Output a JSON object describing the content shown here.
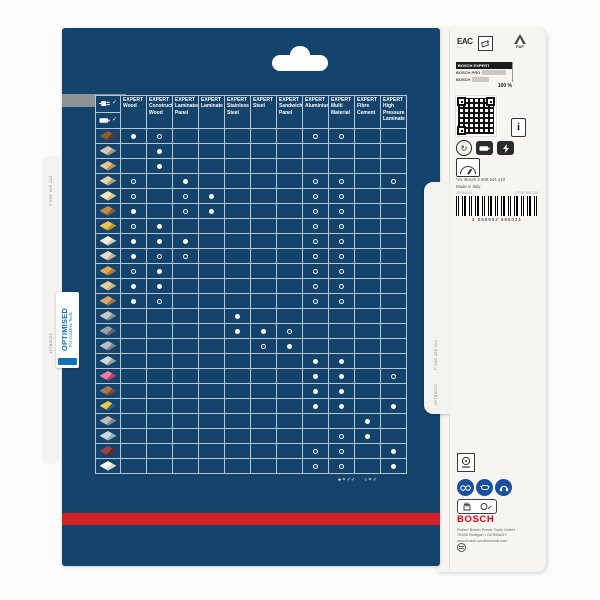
{
  "colors": {
    "panel_blue": "#14436b",
    "stripe_red": "#d42127",
    "bosch_red": "#e20015",
    "grid_line": "#b7c6d3",
    "ppe_blue": "#1a4f9e",
    "optimised_blue": "#1272b9"
  },
  "left_side": {
    "optimised_title": "OPTIMISED",
    "optimised_subtitle": "For Cordless Tools",
    "edge_code_top": "F 03E 426 110",
    "edge_code_bottom": "15TB0025"
  },
  "door_tab": {
    "code_top": "F 03E 426 110",
    "code_bottom": "15TB0025"
  },
  "matrix": {
    "power_rows": [
      {
        "icon": "corded-plug-icon",
        "check": "✓"
      },
      {
        "icon": "cordless-battery-icon",
        "check": "✓"
      }
    ],
    "columns": [
      {
        "brand": "EXPERT",
        "name": "Wood"
      },
      {
        "brand": "EXPERT",
        "name": "Construct Wood"
      },
      {
        "brand": "EXPERT",
        "name": "Laminated Panel"
      },
      {
        "brand": "EXPERT",
        "name": "Laminate"
      },
      {
        "brand": "EXPERT",
        "name": "Stainless Steel"
      },
      {
        "brand": "EXPERT",
        "name": "Steel"
      },
      {
        "brand": "EXPERT",
        "name": "Sandwich Panel"
      },
      {
        "brand": "EXPERT",
        "name": "Aluminium"
      },
      {
        "brand": "EXPERT",
        "name": "Multi Material"
      },
      {
        "brand": "EXPERT",
        "name": "Fibre Cement"
      },
      {
        "brand": "EXPERT",
        "name": "High Pressure Laminate"
      }
    ],
    "rows": [
      {
        "material": "solid-wood",
        "colors": [
          "#5f3a22",
          "#8a5a33"
        ],
        "marks": [
          "f",
          "o",
          "",
          "",
          "",
          "",
          "",
          "o",
          "o",
          "",
          ""
        ]
      },
      {
        "material": "nailed-wood",
        "colors": [
          "#a89a82",
          "#d6c9b0"
        ],
        "marks": [
          "",
          "f",
          "",
          "",
          "",
          "",
          "",
          "",
          "",
          "",
          ""
        ]
      },
      {
        "material": "construction-timber",
        "colors": [
          "#b7945e",
          "#e0c496"
        ],
        "marks": [
          "",
          "f",
          "",
          "",
          "",
          "",
          "",
          "",
          "",
          "",
          ""
        ]
      },
      {
        "material": "chipboard",
        "colors": [
          "#b5a079",
          "#e3d2b0"
        ],
        "marks": [
          "o",
          "",
          "f",
          "",
          "",
          "",
          "",
          "o",
          "o",
          "",
          "o"
        ]
      },
      {
        "material": "laminate-flooring",
        "colors": [
          "#d8c68e",
          "#f2e6c0"
        ],
        "marks": [
          "o",
          "",
          "o",
          "f",
          "",
          "",
          "",
          "o",
          "o",
          "",
          ""
        ]
      },
      {
        "material": "parquet",
        "colors": [
          "#8f5e2d",
          "#c08a4a"
        ],
        "marks": [
          "f",
          "",
          "o",
          "f",
          "",
          "",
          "",
          "o",
          "o",
          "",
          ""
        ]
      },
      {
        "material": "osb-board",
        "colors": [
          "#c79a24",
          "#eec54e"
        ],
        "marks": [
          "o",
          "f",
          "",
          "",
          "",
          "",
          "",
          "o",
          "o",
          "",
          ""
        ]
      },
      {
        "material": "plywood",
        "colors": [
          "#d8ccb2",
          "#f5eee0"
        ],
        "marks": [
          "f",
          "f",
          "f",
          "",
          "",
          "",
          "",
          "o",
          "o",
          "",
          ""
        ]
      },
      {
        "material": "mdf-board",
        "colors": [
          "#c4b190",
          "#e8dcc0"
        ],
        "marks": [
          "f",
          "o",
          "o",
          "",
          "",
          "",
          "",
          "o",
          "o",
          "",
          ""
        ]
      },
      {
        "material": "hardwood",
        "colors": [
          "#b27a34",
          "#e0a855"
        ],
        "marks": [
          "o",
          "f",
          "",
          "",
          "",
          "",
          "",
          "o",
          "o",
          "",
          ""
        ]
      },
      {
        "material": "timber-beams",
        "colors": [
          "#bda briefly",
          "#e2cda0"
        ],
        "marks": [
          "f",
          "f",
          "",
          "",
          "",
          "",
          "",
          "o",
          "o",
          "",
          ""
        ]
      },
      {
        "material": "layered-wood",
        "colors": [
          "#a37846",
          "#d4a870"
        ],
        "marks": [
          "f",
          "o",
          "",
          "",
          "",
          "",
          "",
          "o",
          "o",
          "",
          ""
        ]
      },
      {
        "material": "stainless-steel-sheet",
        "colors": [
          "#8a9298",
          "#c2c8cc"
        ],
        "marks": [
          "",
          "",
          "",
          "",
          "f",
          "",
          "",
          "",
          "",
          "",
          ""
        ]
      },
      {
        "material": "steel-profiles",
        "colors": [
          "#5f666c",
          "#9aa1a6"
        ],
        "marks": [
          "",
          "",
          "",
          "",
          "f",
          "f",
          "o",
          "",
          "",
          "",
          ""
        ]
      },
      {
        "material": "sandwich-panel",
        "colors": [
          "#7f878c",
          "#b8bfc4"
        ],
        "marks": [
          "",
          "",
          "",
          "",
          "",
          "o",
          "f",
          "",
          "",
          "",
          ""
        ]
      },
      {
        "material": "aluminium-profiles",
        "colors": [
          "#9aa2a8",
          "#d0d6da"
        ],
        "marks": [
          "",
          "",
          "",
          "",
          "",
          "",
          "",
          "f",
          "f",
          "",
          ""
        ]
      },
      {
        "material": "acrylic-panel",
        "colors": [
          "#c94068",
          "#ef7fa0"
        ],
        "marks": [
          "",
          "",
          "",
          "",
          "",
          "",
          "",
          "f",
          "f",
          "",
          "o"
        ]
      },
      {
        "material": "multi-material",
        "colors": [
          "#7a4a2a",
          "#a87850"
        ],
        "marks": [
          "",
          "",
          "",
          "",
          "",
          "",
          "",
          "f",
          "f",
          "",
          ""
        ]
      },
      {
        "material": "multilayer-panel",
        "colors": [
          "#2f5a94",
          "#e8c84a"
        ],
        "marks": [
          "",
          "",
          "",
          "",
          "",
          "",
          "",
          "f",
          "f",
          "",
          "f"
        ]
      },
      {
        "material": "fibre-cement-board",
        "colors": [
          "#8a8a86",
          "#bcbcb8"
        ],
        "marks": [
          "",
          "",
          "",
          "",
          "",
          "",
          "",
          "",
          "",
          "f",
          ""
        ]
      },
      {
        "material": "plasterboard",
        "colors": [
          "#9fb0b8",
          "#cfdae0"
        ],
        "marks": [
          "",
          "",
          "",
          "",
          "",
          "",
          "",
          "",
          "o",
          "f",
          ""
        ]
      },
      {
        "material": "hpl-board",
        "colors": [
          "#6a2424",
          "#9a4444"
        ],
        "marks": [
          "",
          "",
          "",
          "",
          "",
          "",
          "",
          "o",
          "o",
          "",
          "f"
        ]
      },
      {
        "material": "laminate-panel",
        "colors": [
          "#d8d8d2",
          "#f8f8f4"
        ],
        "marks": [
          "",
          "",
          "",
          "",
          "",
          "",
          "",
          "o",
          "o",
          "",
          "f"
        ]
      }
    ],
    "legend": {
      "filled": "● = ✓✓",
      "open": "○ = ✓"
    }
  },
  "label": {
    "eac_text": "EAC",
    "pap_text": "PAP",
    "comparison": {
      "rows": [
        {
          "name": "BOSCH EXPERT"
        },
        {
          "name": "BOSCH PRO"
        },
        {
          "name": "BOSCH"
        }
      ],
      "value_label": "100 %"
    },
    "info_icon_text": "i",
    "compare_note": "*vs. Bosch 2 608 644 410",
    "origin": "Made in Italy",
    "print_code_left": "15TB0025",
    "print_code_right": "F 03E 426 110",
    "barcode_digits": "4 059952 685021",
    "logo_text": "BOSCH",
    "address": [
      "Robert Bosch Power Tools GmbH",
      "70538 Stuttgart • GERMANY",
      "www.bosch-professional.com"
    ]
  }
}
